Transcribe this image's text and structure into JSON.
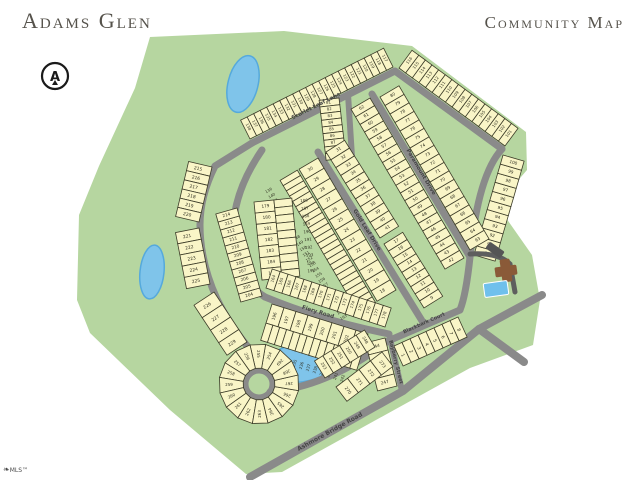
{
  "header": {
    "title": "Adams Glen",
    "subtitle": "Community Map"
  },
  "footer": {
    "logo_text": "MLS™"
  },
  "compass": {
    "letter": "A",
    "cx": 55,
    "cy": 76,
    "r": 13
  },
  "colors": {
    "land": "#b6d6a0",
    "lot_fill": "#f9f5c7",
    "lot_stroke": "#3c3c28",
    "lot_number": "#2f2f20",
    "road": "#8a8a8a",
    "road_label": "#454545",
    "pond": "#7fc4ea",
    "pond_deep": "#55a9dc",
    "pool": "#6fc0ec",
    "building": "#8a5a38",
    "driveway": "#5e5e5e",
    "title_color": "#55524b"
  },
  "map": {
    "land": [
      [
        150,
        37
      ],
      [
        284,
        31
      ],
      [
        412,
        46
      ],
      [
        526,
        132
      ],
      [
        527,
        170
      ],
      [
        497,
        205
      ],
      [
        532,
        255
      ],
      [
        540,
        300
      ],
      [
        533,
        345
      ],
      [
        470,
        368
      ],
      [
        300,
        462
      ],
      [
        282,
        472
      ],
      [
        246,
        474
      ],
      [
        170,
        410
      ],
      [
        90,
        333
      ],
      [
        77,
        300
      ],
      [
        79,
        215
      ],
      [
        99,
        166
      ],
      [
        135,
        88
      ]
    ],
    "ponds": [
      {
        "cx": 243,
        "cy": 84,
        "rx": 15,
        "ry": 29,
        "rot": 14
      },
      {
        "cx": 152,
        "cy": 272,
        "rx": 12,
        "ry": 27,
        "rot": 6
      },
      {
        "cx": 300,
        "cy": 363,
        "rx": 36,
        "ry": 19,
        "rot": -8
      }
    ],
    "roads": [
      {
        "d": "M 252 143 L 215 166 Q 200 196 200 225 Q 200 262 217 299 Q 229 324 252 352",
        "w": 7
      },
      {
        "circle": [
          259,
          384,
          14
        ],
        "w": 7
      },
      {
        "d": "M 270 392 Q 330 386 388 341",
        "w": 7
      },
      {
        "d": "M 388 341 L 460 310",
        "w": 7
      },
      {
        "d": "M 389 334 L 402 391",
        "w": 6
      },
      {
        "d": "M 250 477 L 403 391 L 479 329 L 542 295",
        "w": 8
      },
      {
        "d": "M 479 329 L 524 362",
        "w": 8
      },
      {
        "d": "M 252 143 L 395 71 L 502 149",
        "w": 7
      },
      {
        "d": "M 348 94 L 352 157",
        "w": 6
      },
      {
        "d": "M 318 152 L 424 324",
        "w": 7
      },
      {
        "d": "M 262 150 Q 224 205 236 258 Q 243 283 265 297",
        "w": 7
      },
      {
        "d": "M 265 297 Q 320 320 389 334",
        "w": 7
      },
      {
        "d": "M 372 94 L 470 257",
        "w": 7
      },
      {
        "d": "M 502 149 Q 478 175 470 257 Q 466 295 460 310",
        "w": 7
      }
    ],
    "lot_blocks": [
      {
        "from": 117,
        "to": 138,
        "a": [
          393,
          67
        ],
        "b": [
          250,
          139
        ],
        "side": 1,
        "depth": 21,
        "fs": 3.9
      },
      {
        "from": 101,
        "to": 116,
        "a": [
          505,
          146
        ],
        "b": [
          399,
          68
        ],
        "side": 1,
        "depth": 22,
        "fs": 4.0
      },
      {
        "from": 90,
        "to": 100,
        "a": [
          474,
          255
        ],
        "b": [
          503,
          155
        ],
        "side": 1,
        "depth": 22,
        "fs": 4.2
      },
      {
        "from": 81,
        "to": 89,
        "a": [
          339,
          98
        ],
        "b": [
          346,
          158
        ],
        "side": 1,
        "depth": 20,
        "fs": 3.9
      },
      {
        "from": 63,
        "to": 80,
        "a": [
          470,
          250
        ],
        "b": [
          380,
          97
        ],
        "side": 1,
        "depth": 22,
        "fs": 4.2
      },
      {
        "from": 42,
        "to": 62,
        "a": [
          464,
          258
        ],
        "b": [
          370,
          98
        ],
        "side": -1,
        "depth": 22,
        "fs": 4.2
      },
      {
        "from": 31,
        "to": 41,
        "a": [
          326,
          152
        ],
        "b": [
          380,
          238
        ],
        "side": -1,
        "depth": 22,
        "fs": 4.2
      },
      {
        "from": 18,
        "to": 30,
        "a": [
          396,
          290
        ],
        "b": [
          318,
          158
        ],
        "side": -1,
        "depth": 22,
        "fs": 4.2
      },
      {
        "from": 139,
        "to": 163,
        "a": [
          318,
          158
        ],
        "b": [
          396,
          290
        ],
        "side": 1,
        "depth": 20,
        "offset": 24,
        "fs": 3.8
      },
      {
        "from": 9,
        "to": 17,
        "a": [
          424,
          308
        ],
        "b": [
          384,
          244
        ],
        "side": 1,
        "depth": 22,
        "fs": 4.2
      },
      {
        "from": 179,
        "to": 185,
        "a": [
          254,
          202
        ],
        "b": [
          262,
          280
        ],
        "side": -1,
        "depth": 20,
        "fs": 4.2
      },
      {
        "from": 186,
        "to": 195,
        "a": [
          254,
          202
        ],
        "b": [
          262,
          280
        ],
        "side": -1,
        "depth": 18,
        "offset": 20,
        "fs": 3.9
      },
      {
        "from": 164,
        "to": 178,
        "a": [
          266,
          288
        ],
        "b": [
          385,
          327
        ],
        "side": -1,
        "depth": 20,
        "fs": 4.0
      },
      {
        "from": 196,
        "to": 203,
        "a": [
          272,
          304
        ],
        "b": [
          368,
          334
        ],
        "side": 1,
        "depth": 20,
        "fs": 4.2
      },
      {
        "from": 230,
        "to": 243,
        "a": [
          272,
          304
        ],
        "b": [
          368,
          334
        ],
        "side": 1,
        "depth": 18,
        "offset": 20,
        "fs": 3.9
      },
      {
        "from": 204,
        "to": 214,
        "a": [
          262,
          296
        ],
        "b": [
          237,
          208
        ],
        "side": -1,
        "depth": 22,
        "fs": 4.2
      },
      {
        "from": 215,
        "to": 220,
        "a": [
          212,
          167
        ],
        "b": [
          199,
          222
        ],
        "side": 1,
        "depth": 24,
        "fs": 4.4
      },
      {
        "from": 221,
        "to": 225,
        "a": [
          199,
          228
        ],
        "b": [
          210,
          284
        ],
        "side": 1,
        "depth": 24,
        "fs": 4.4
      },
      {
        "from": 226,
        "to": 229,
        "a": [
          214,
          292
        ],
        "b": [
          247,
          342
        ],
        "side": 1,
        "depth": 24,
        "fs": 4.4
      },
      {
        "from": 244,
        "to": 247,
        "a": [
          385,
          338
        ],
        "b": [
          397,
          386
        ],
        "side": 1,
        "depth": 20,
        "fs": 4.2
      },
      {
        "from": 248,
        "to": 253,
        "a": [
          375,
          347
        ],
        "b": [
          325,
          378
        ],
        "side": 1,
        "depth": 20,
        "fs": 4.0
      },
      {
        "from": 270,
        "to": 273,
        "a": [
          336,
          387
        ],
        "b": [
          382,
          352
        ],
        "side": 1,
        "depth": 18,
        "fs": 4.2
      },
      {
        "from": 1,
        "to": 8,
        "a": [
          394,
          346
        ],
        "b": [
          458,
          317
        ],
        "side": 1,
        "depth": 22,
        "fs": 4.4
      },
      {
        "type": "fan",
        "from": 254,
        "to": 269,
        "cx": 259,
        "cy": 384,
        "r1": 16,
        "r2": 40,
        "start": -58,
        "step": -22.5,
        "fs": 4.0
      }
    ],
    "street_labels": [
      {
        "text": "Scarlet Leaf Lane",
        "x": 316,
        "y": 106,
        "angle": -27,
        "fs": 5.5
      },
      {
        "text": "Paramount Drive",
        "x": 421,
        "y": 172,
        "angle": 59,
        "fs": 5.5
      },
      {
        "text": "Gold Leaf Drive",
        "x": 367,
        "y": 230,
        "angle": 58,
        "fs": 5.5
      },
      {
        "text": "Fiery Road",
        "x": 318,
        "y": 312,
        "angle": 17,
        "fs": 5.5
      },
      {
        "text": "Blackbark Court",
        "x": 424,
        "y": 323,
        "angle": -24,
        "fs": 5.0
      },
      {
        "text": "Bayberry Street",
        "x": 396,
        "y": 362,
        "angle": 76,
        "fs": 5.0
      },
      {
        "text": "Ashmore Bridge Road",
        "x": 330,
        "y": 432,
        "angle": -29,
        "fs": 6.0
      }
    ],
    "amenity": {
      "drive": "M 470 254 Q 498 252 510 264 L 515 292",
      "deck": {
        "x": 486,
        "y": 246,
        "w": 18,
        "h": 8,
        "rot": 35
      },
      "building_h": {
        "x": 495,
        "y": 266,
        "w": 22,
        "h": 10,
        "rot": -8
      },
      "building_v": {
        "x": 501,
        "y": 259,
        "w": 10,
        "h": 23,
        "rot": -8
      },
      "pool": {
        "x": 484,
        "y": 282,
        "w": 24,
        "h": 14,
        "rot": -8
      }
    }
  }
}
